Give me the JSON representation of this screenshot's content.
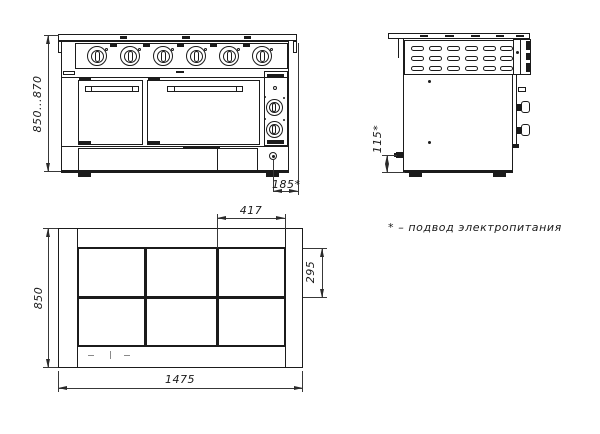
{
  "drawing": {
    "note": "* – подвод электропитания",
    "dims": {
      "overall_height": "850...870",
      "inlet_offset_x": "185*",
      "inlet_height": "115*",
      "burner_module_width": "417",
      "burner_module_depth": "295",
      "top_depth": "850",
      "top_width": "1475"
    },
    "line_color": "#1b1b1b"
  }
}
